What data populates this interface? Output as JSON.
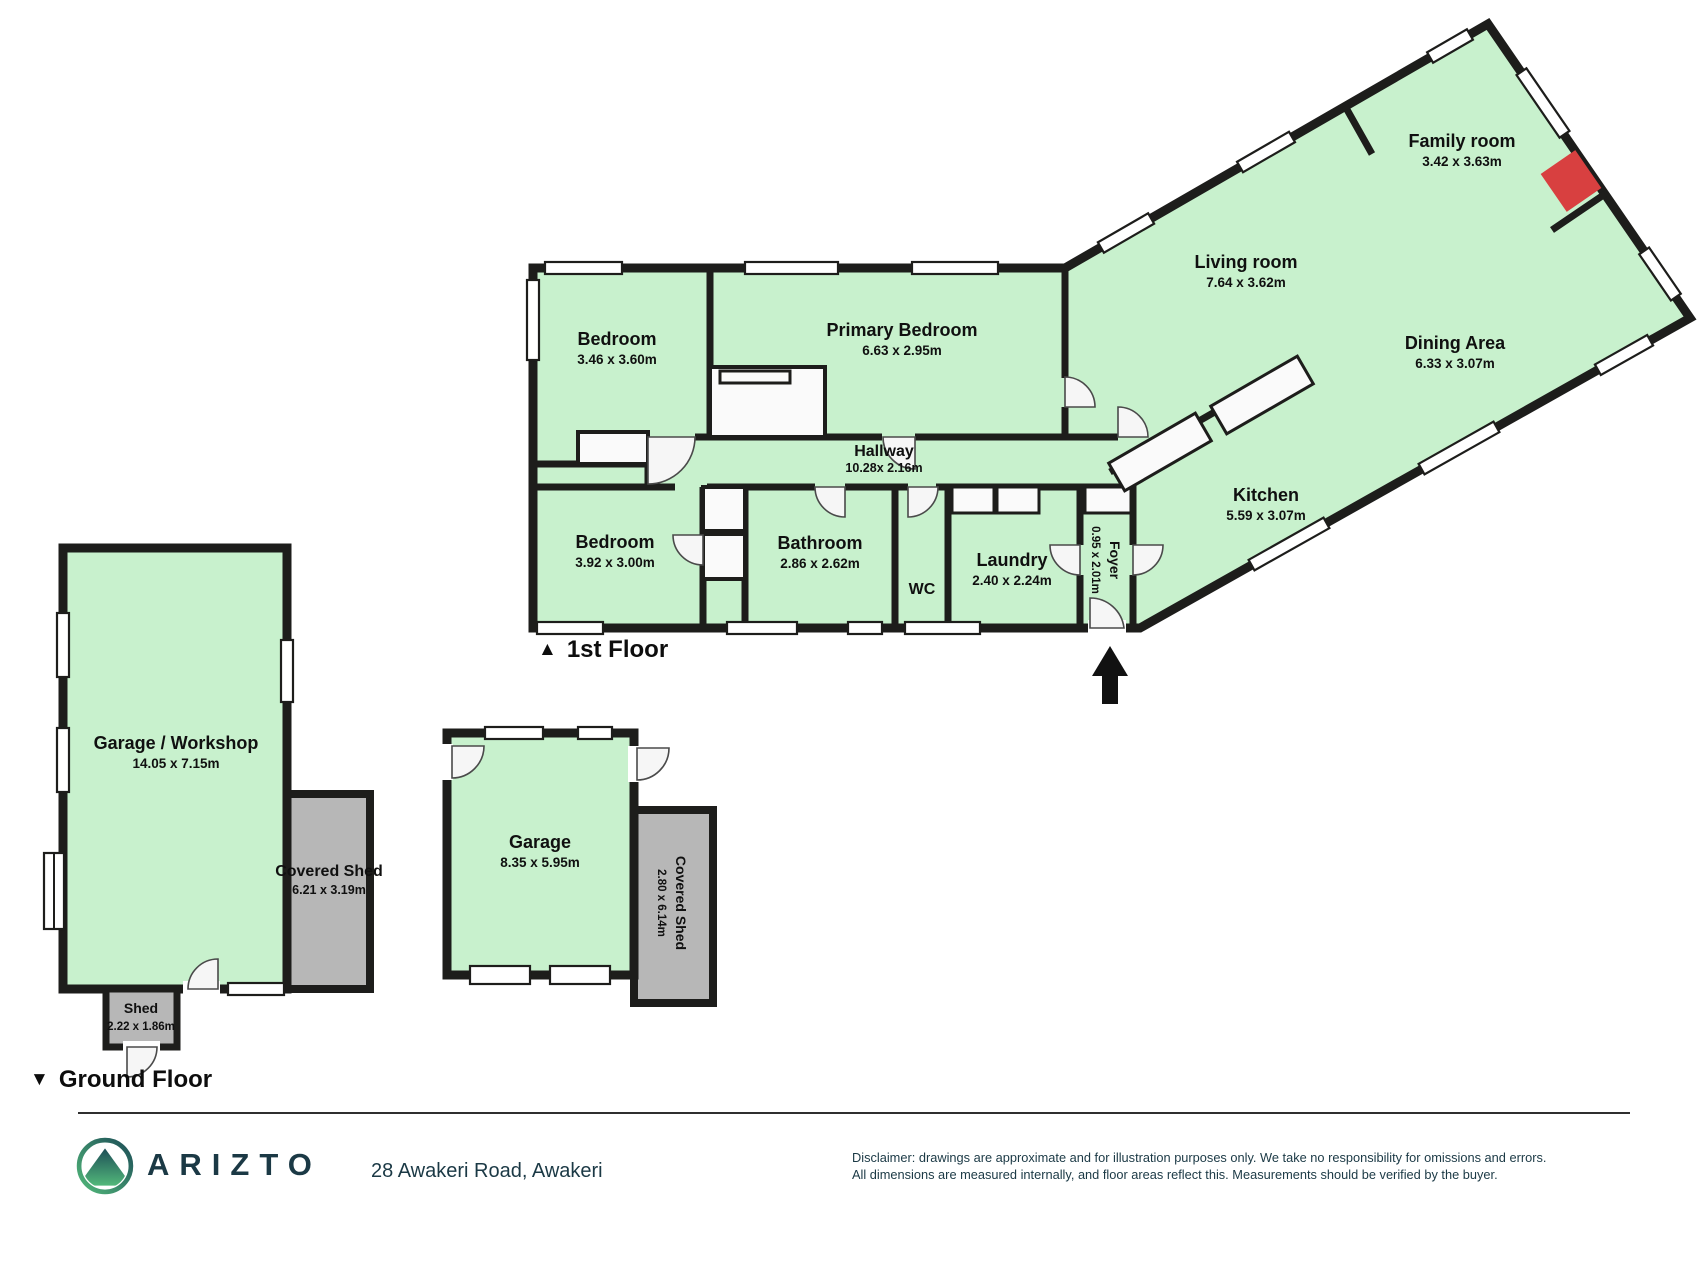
{
  "first_floor": {
    "marker": "▲",
    "label": "1st Floor",
    "rooms": {
      "bedroom1": {
        "name": "Bedroom",
        "dims": "3.46 x 3.60m"
      },
      "primary_bedroom": {
        "name": "Primary Bedroom",
        "dims": "6.63 x 2.95m"
      },
      "family_room": {
        "name": "Family room",
        "dims": "3.42 x 3.63m"
      },
      "living_room": {
        "name": "Living room",
        "dims": "7.64 x 3.62m"
      },
      "dining_area": {
        "name": "Dining Area",
        "dims": "6.33 x 3.07m"
      },
      "hallway": {
        "name": "Hallway",
        "dims": "10.28x 2.16m"
      },
      "kitchen": {
        "name": "Kitchen",
        "dims": "5.59 x 3.07m"
      },
      "bedroom2": {
        "name": "Bedroom",
        "dims": "3.92 x 3.00m"
      },
      "bathroom": {
        "name": "Bathroom",
        "dims": "2.86 x 2.62m"
      },
      "wc": {
        "name": "WC"
      },
      "laundry": {
        "name": "Laundry",
        "dims": "2.40 x 2.24m"
      },
      "foyer": {
        "name": "Foyer",
        "dims": "0.95 x 2.01m"
      }
    }
  },
  "ground_floor": {
    "marker": "▼",
    "label": "Ground Floor",
    "rooms": {
      "garage_workshop": {
        "name": "Garage / Workshop",
        "dims": "14.05 x 7.15m"
      },
      "covered_shed_left": {
        "name": "Covered Shed",
        "dims": "6.21 x 3.19m"
      },
      "shed": {
        "name": "Shed",
        "dims": "2.22 x 1.86m"
      },
      "garage": {
        "name": "Garage",
        "dims": "8.35 x 5.95m"
      },
      "covered_shed_right": {
        "name": "Covered Shed",
        "dims": "2.80 x 6.14m"
      }
    }
  },
  "footer": {
    "brand": "ARIZTO",
    "address": "28 Awakeri Road, Awakeri",
    "disclaimer_line1": "Disclaimer: drawings are approximate and for illustration purposes only. We take no responsibility for omissions and errors.",
    "disclaimer_line2": "All dimensions are measured internally, and floor areas reflect this. Measurements should be verified by the buyer."
  },
  "colors": {
    "room_fill": "#c8f1cd",
    "shed_fill": "#b7b7b7",
    "wall": "#1d1d1b",
    "fireplace_red": "#d84040",
    "brand_navy": "#1b3945",
    "logo_teal": "#1d4e57",
    "logo_green": "#52b87a"
  }
}
